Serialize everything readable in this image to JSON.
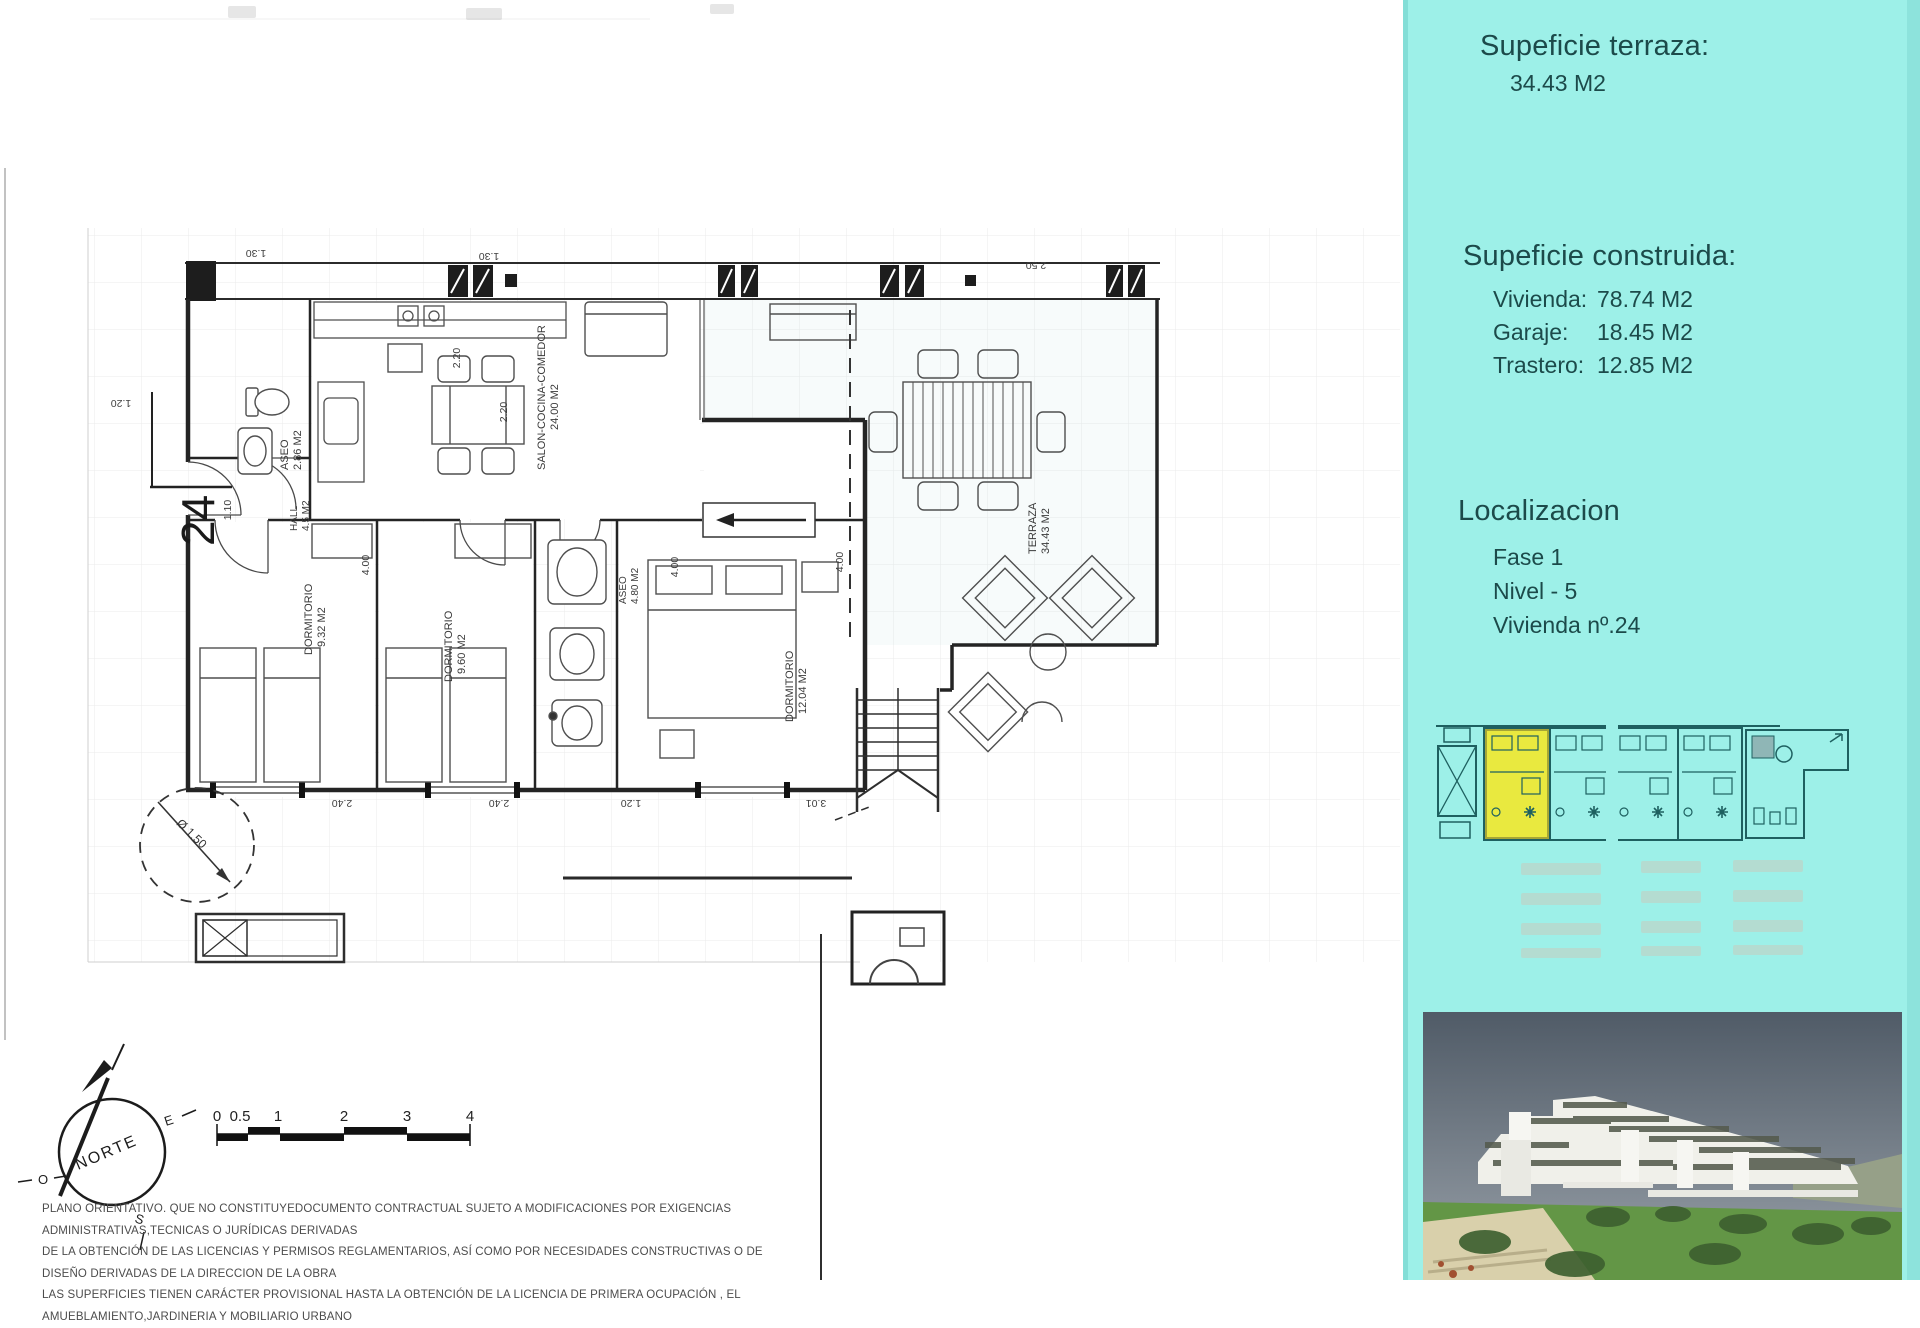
{
  "panel": {
    "terrace_title": "Supeficie terraza:",
    "terrace_value": "34.43 M2",
    "built_title": "Supeficie construida:",
    "built_rows": [
      {
        "label": "Vivienda:",
        "value": "78.74 M2"
      },
      {
        "label": "Garaje:",
        "value": "18.45 M2"
      },
      {
        "label": "Trastero:",
        "value": "12.85 M2"
      }
    ],
    "location_title": "Localizacion",
    "location_lines": [
      "Fase 1",
      "Nivel - 5",
      "Vivienda nº.24"
    ],
    "accent_bg": "#9DF0E8",
    "highlight_yellow": "#E9E93F",
    "minimap_line_color": "#1E6060"
  },
  "plan": {
    "unit_number": "24",
    "rooms": [
      {
        "name": "ASEO",
        "area": "2.86 M2"
      },
      {
        "name": "HALL",
        "area": "4.5 M2"
      },
      {
        "name": "SALON-COCINA-COMEDOR",
        "area": "24.00 M2"
      },
      {
        "name": "DORMITORIO",
        "area": "9.32 M2"
      },
      {
        "name": "DORMITORIO",
        "area": "9.60 M2"
      },
      {
        "name": "ASEO",
        "area": "4.80 M2"
      },
      {
        "name": "DORMITORIO",
        "area": "12.04 M2"
      },
      {
        "name": "TERRAZA",
        "area": "34.43 M2"
      }
    ],
    "dims": {
      "d130a": "1.30",
      "d130b": "1.30",
      "d250": "2.50",
      "d220a": "2.20",
      "d220b": "2.20",
      "d110": "1.10",
      "d120a": "1.20",
      "d400a": "4.00",
      "d400b": "4.00",
      "d400c": "4.00",
      "d240a": "2.40",
      "d240b": "2.40",
      "d120b": "1.20",
      "d301": "3.01",
      "circle": "Ø 1.50"
    },
    "compass": {
      "north": "NORTE",
      "east": "E",
      "west": "O",
      "south": "S"
    },
    "scalebar": [
      "0",
      "0.5",
      "1",
      "2",
      "3",
      "4"
    ]
  },
  "disclaimer": {
    "line1": "PLANO ORIENTATIVO. QUE NO CONSTITUYEDOCUMENTO CONTRACTUAL SUJETO A MODIFICACIONES POR EXIGENCIAS ADMINISTRATIVAS,TECNICAS O JURÍDICAS DERIVADAS",
    "line2": "DE LA OBTENCIÓN DE LAS LICENCIAS Y PERMISOS REGLAMENTARIOS, ASÍ COMO POR NECESIDADES CONSTRUCTIVAS  O DE DISEÑO DERIVADAS DE LA DIRECCION DE LA OBRA",
    "line3": "LAS SUPERFICIES TIENEN CARÁCTER PROVISIONAL HASTA LA OBTENCIÓN DE LA LICENCIA DE PRIMERA OCUPACIÓN , EL AMUEBLAMIENTO,JARDINERIA Y MOBILIARIO URBANO"
  }
}
